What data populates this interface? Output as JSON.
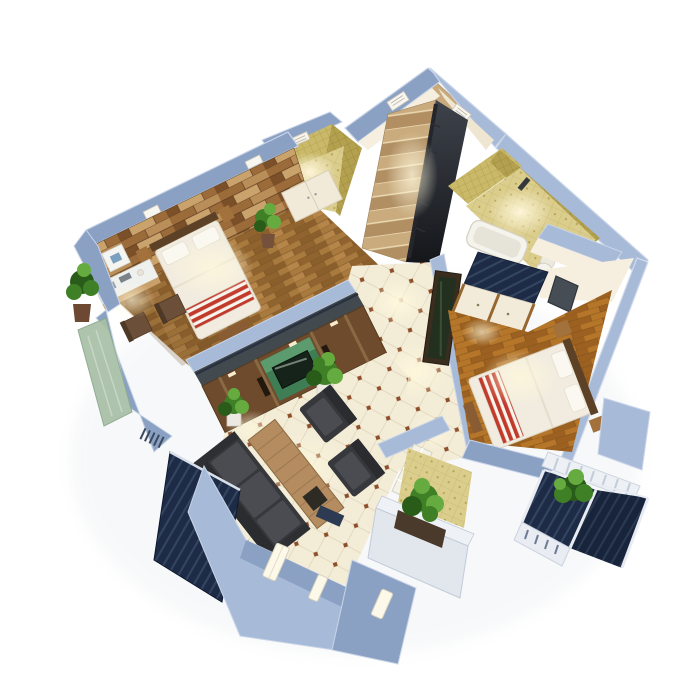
{
  "scene": {
    "title": "3D Floor Plan Render",
    "description": "Isometric 3D cutaway rendering of a furnished single-storey apartment floor plan on a white background, slate-blue exterior walls, warm interior lighting",
    "view": "isometric dollhouse cutaway from above",
    "background": "#ffffff"
  },
  "colors": {
    "wall_top": "#c9d5e8",
    "wall_light": "#a7bad8",
    "wall_mid": "#8ba1c4",
    "wall_dark": "#7287ac",
    "interior_wall": "#f6efdf",
    "tile_floor": "#f3ecd7",
    "tile_line": "#e2d9bf",
    "tile_dot": "#8d4e2a",
    "wood_floor": "#a87a3e",
    "wood_floor_dark": "#8a5f2c",
    "wood_mid": "#b5854a",
    "wood_deep": "#91642f",
    "wood2_a": "#b5762a",
    "wood2_b": "#9c6120",
    "plank_a": "#9c6b3a",
    "plank_b": "#b98e58",
    "plank_c": "#7b4f28",
    "plank_d": "#caa36c",
    "stair_tread": "#c9ab7e",
    "stair_tread_dark": "#b18f63",
    "stair_void_dark": "#14161a",
    "navy": "#1d2b47",
    "navy_slat": "#33455f",
    "charcoal": "#42494f",
    "sofa": "#37383c",
    "sofa_light": "#4a4c51",
    "table_wood": "#b48c5f",
    "bed": "#f1ecdf",
    "pillow": "#faf8f1",
    "headboard": "#5c4127",
    "stripe_red": "#c23a2c",
    "plant": "#3f8026",
    "plant_light": "#66ab3f",
    "plant_dark": "#2a5c19",
    "pot": "#8a5d3b",
    "gold_wall": "#c9b968",
    "gold_wall_dark": "#b3a14f",
    "gold_floor": "#dbcd8c",
    "fixture": "#f4f3ec",
    "planter_white": "#e2e7ee",
    "glass_green": "#a8bfa6",
    "glow": "#fff8dc"
  },
  "rooms": [
    {
      "id": "master-bedroom",
      "name": "Master Bedroom",
      "position": "upper-left",
      "floor": "wood planks",
      "features": [
        "timber mosaic feature wall",
        "double bed with white duvet",
        "red-and-white striped runner",
        "two pillows",
        "vanity desk with two chairs",
        "white wall cabinet",
        "white wardrobe",
        "corner potted plant"
      ]
    },
    {
      "id": "living-room",
      "name": "Living Room",
      "position": "center-left",
      "floor": "cream tile with diamond dots",
      "features": [
        "media wall with green TV backdrop",
        "charcoal three-seat sofa",
        "two charcoal armchairs",
        "long wood coffee table",
        "potted plants beside TV"
      ]
    },
    {
      "id": "hallway",
      "name": "Hallway",
      "position": "center",
      "floor": "cream tile with diamond dots",
      "features": [
        "leaning dark picture frame",
        "bright ceiling light glow"
      ]
    },
    {
      "id": "staircase",
      "name": "Staircase",
      "position": "top-center",
      "features": [
        "wood treads",
        "upper wood landing",
        "dark stairwell void",
        "dark handrail",
        "louvre vent windows"
      ]
    },
    {
      "id": "shower-room",
      "name": "Shower Room",
      "position": "left-of-stairs",
      "features": [
        "gold mosaic walls",
        "warm ceiling light"
      ]
    },
    {
      "id": "bathroom",
      "name": "Bathroom",
      "position": "upper-right",
      "features": [
        "gold mosaic walls",
        "white bathtub",
        "toilet",
        "basin",
        "wall shower fitting"
      ]
    },
    {
      "id": "second-bedroom",
      "name": "Second Bedroom",
      "position": "right",
      "floor": "warm wood planks",
      "features": [
        "double bed with white duvet",
        "red-and-white striped runner",
        "navy slatted canopy over wardrobe",
        "white wardrobe with wood trim",
        "dark window",
        "nightstands"
      ]
    },
    {
      "id": "entrance-porch",
      "name": "Entrance Porch",
      "position": "bottom-center",
      "features": [
        "white french doors with glass panes",
        "gold speckled tile",
        "white planter box with green shrub"
      ]
    },
    {
      "id": "bay-balcony",
      "name": "Bay Balcony",
      "position": "bottom-right",
      "features": [
        "navy slatted bay roof with white ridges",
        "white baluster railing",
        "potted green shrub"
      ]
    },
    {
      "id": "side-balcony",
      "name": "Side Balcony",
      "position": "left-edge",
      "features": [
        "potted plant",
        "green glass panel",
        "louvre vents"
      ]
    },
    {
      "id": "awning-panel",
      "name": "Awning Panel",
      "position": "bottom-left",
      "features": [
        "navy slatted awning leaning against wall"
      ]
    }
  ]
}
